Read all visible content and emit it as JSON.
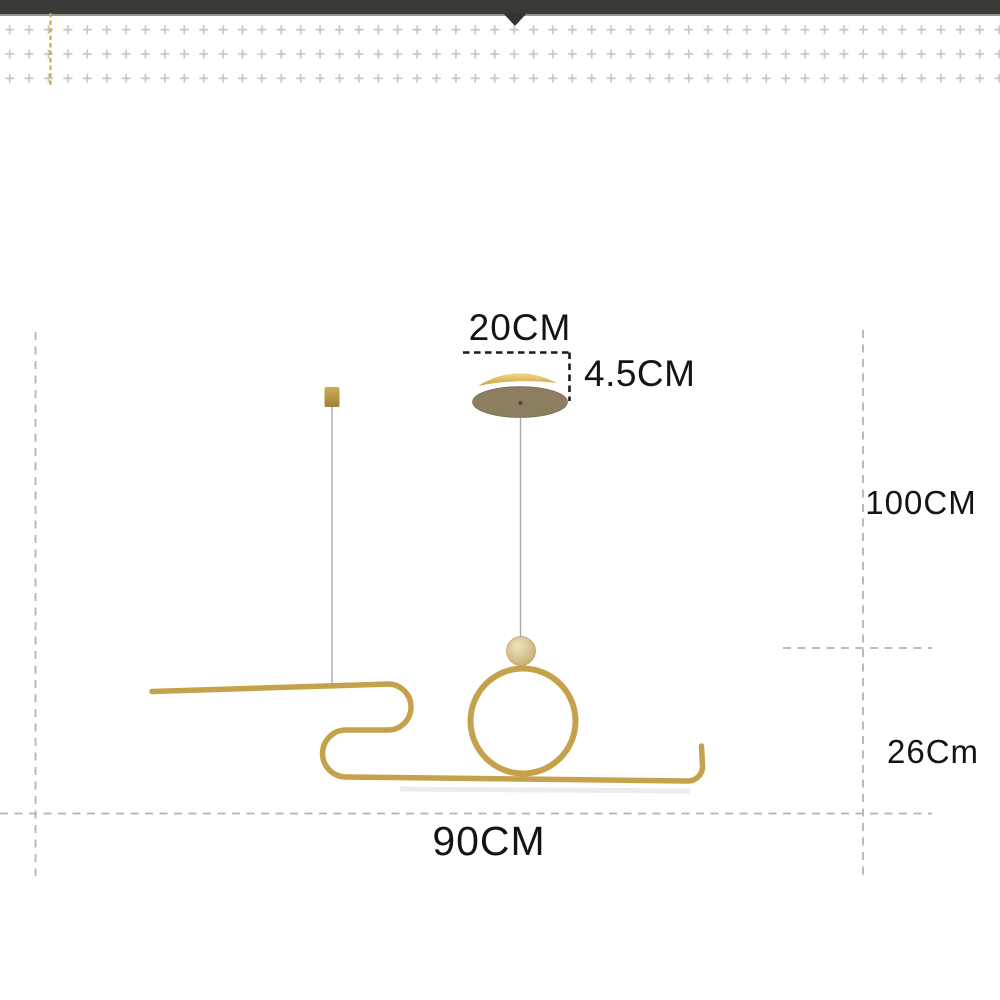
{
  "dimensions": {
    "canopy_width": "20CM",
    "canopy_height": "4.5CM",
    "drop_height": "100CM",
    "fixture_height": "26Cm",
    "fixture_width": "90CM"
  },
  "header": {
    "pointer_icon": "down-triangle"
  },
  "colors": {
    "top_bar": "#3a3a38",
    "top_bar_edge": "#97978f",
    "pointer": "#32322f",
    "gold": "#c6a14b",
    "gold_dash": "#c8a23e",
    "canopy_plate": "#8d7e61",
    "canopy_plate_edge": "#6f6249",
    "canopy_trim": "#d9ae4f",
    "ball": "#d9c394",
    "cable": "#a9a9a9",
    "plus_pattern": "#c6c6c6",
    "dash_gray": "#b3b3b3",
    "dash_black": "#1a1a1a",
    "label_text": "#141414"
  }
}
